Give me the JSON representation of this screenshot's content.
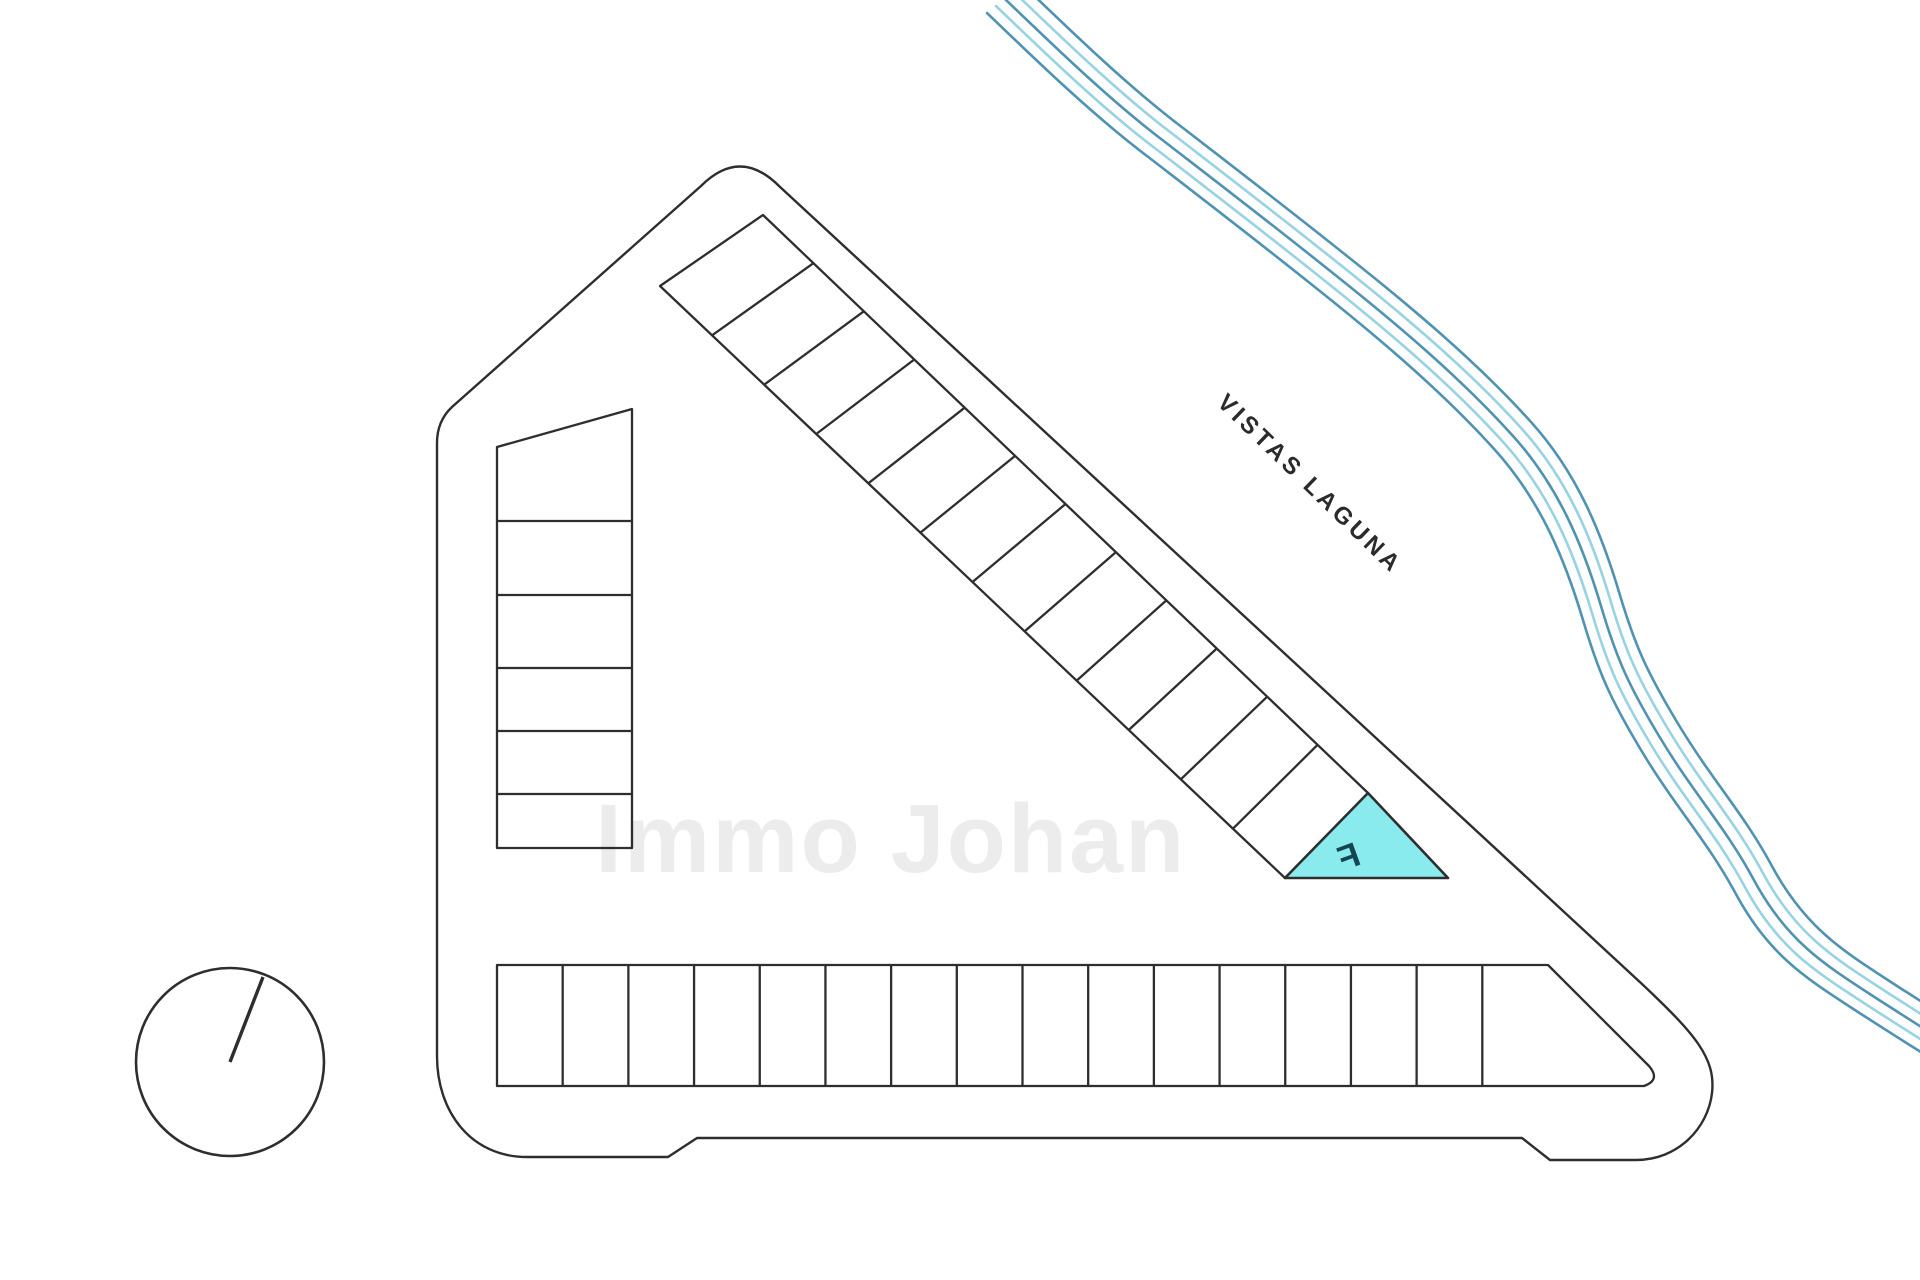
{
  "plan": {
    "title": "site-plan",
    "watermark": "Immo Johan",
    "street_label": "VISTAS LAGUNA",
    "highlighted_plot": {
      "label": "F"
    },
    "rows": {
      "diagonal_row_plots": 12,
      "bottom_row_plots": 16,
      "left_column_plots": 6
    },
    "colors": {
      "background": "#ffffff",
      "outline": "#2e2e2e",
      "highlight_fill": "#89ebee",
      "highlight_label": "#14464f",
      "river_dark": "#4f93b4",
      "river_light": "#97d3e3",
      "street_text": "#2b2b2b",
      "watermark": "#ececec"
    }
  }
}
